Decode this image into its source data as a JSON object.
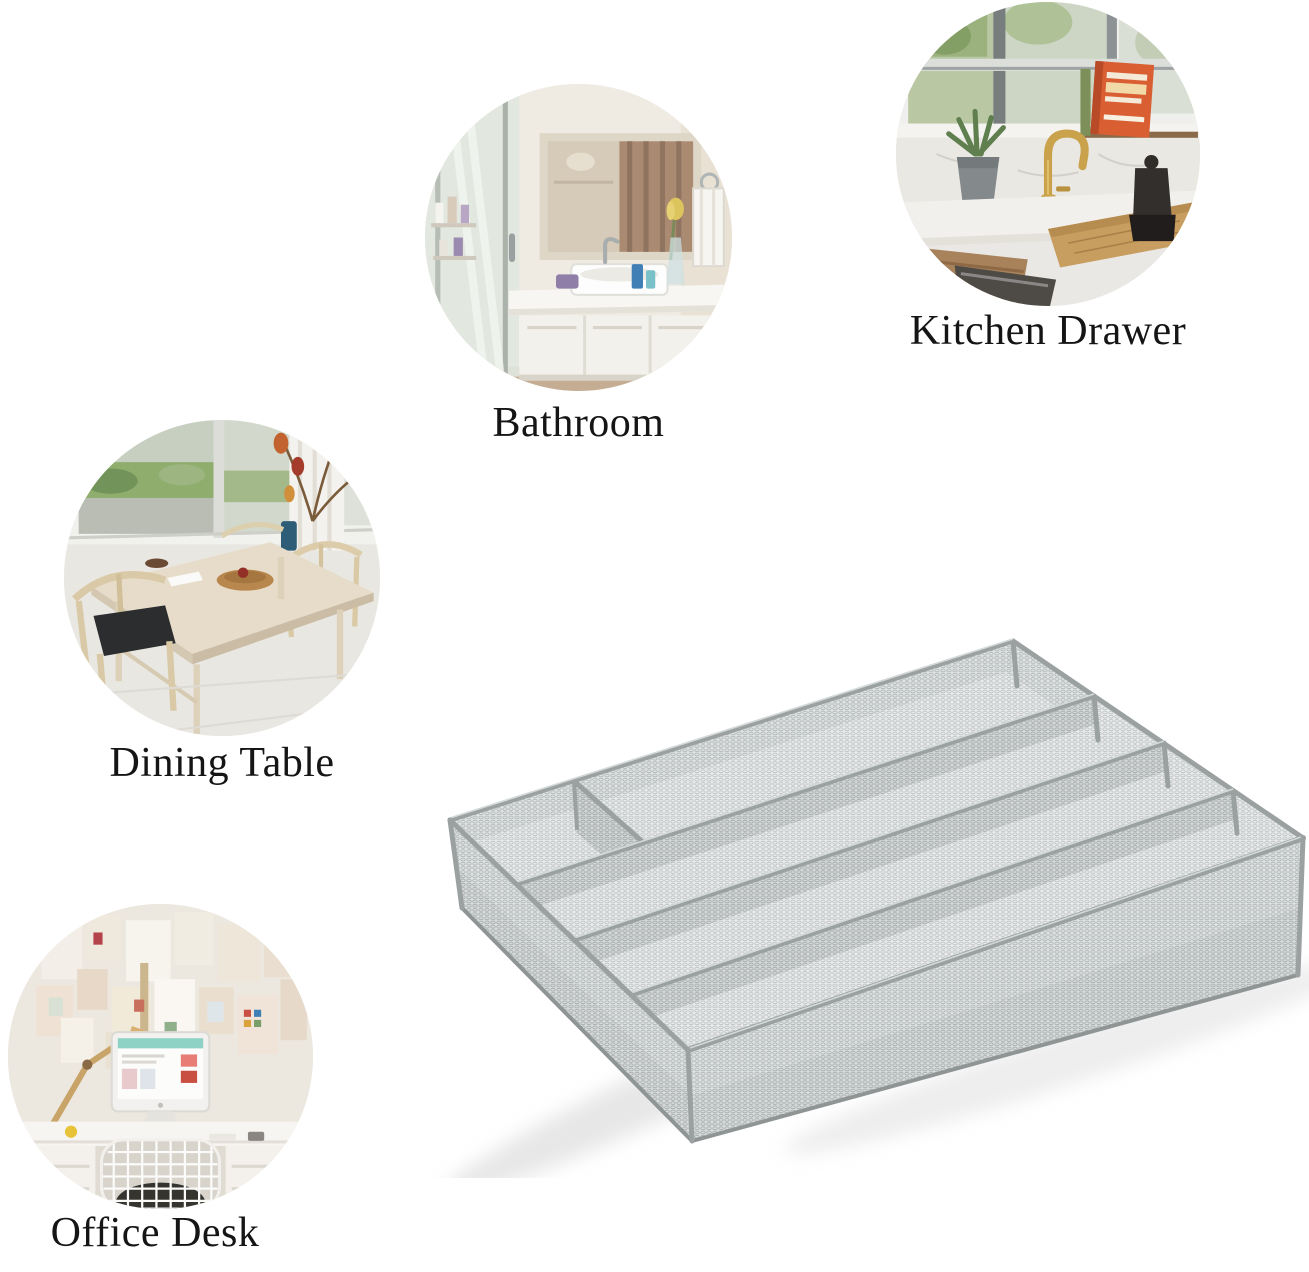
{
  "canvas": {
    "width": 1309,
    "height": 1272,
    "background": "#ffffff"
  },
  "scenes": [
    {
      "id": "kitchen-drawer",
      "label": "Kitchen Drawer"
    },
    {
      "id": "bathroom",
      "label": "Bathroom"
    },
    {
      "id": "dining-table",
      "label": "Dining Table"
    },
    {
      "id": "office-desk",
      "label": "Office Desk"
    }
  ],
  "product": {
    "name": "mesh cutlery tray organizer",
    "compartments": 5,
    "mesh_color": "#e7e9e9",
    "rail_color": "#9ba1a1"
  },
  "colors": {
    "label_text": "#151515",
    "background": "#ffffff"
  }
}
